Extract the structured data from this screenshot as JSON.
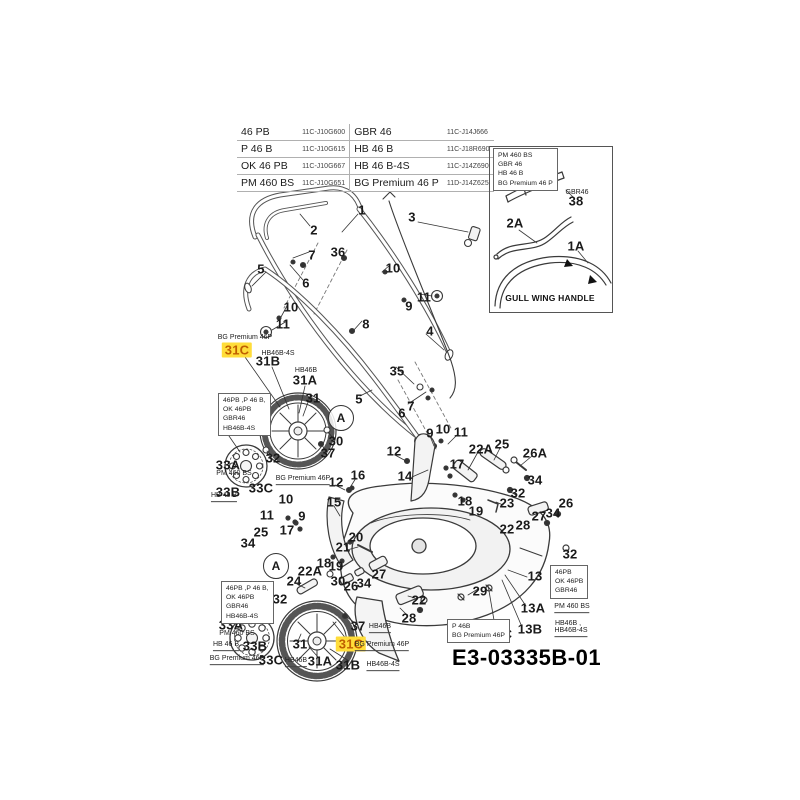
{
  "table": {
    "left": [
      {
        "model": "46 PB",
        "code": "11C-J10G600"
      },
      {
        "model": "P 46 B",
        "code": "11C-J10G615"
      },
      {
        "model": "OK 46 PB",
        "code": "11C-J10G667"
      },
      {
        "model": "PM 460 BS",
        "code": "11C-J10G651"
      }
    ],
    "right": [
      {
        "model": "GBR 46",
        "code": "11C-J14J666"
      },
      {
        "model": "HB 46 B",
        "code": "11C-J18R690"
      },
      {
        "model": "HB 46 B-4S",
        "code": "11C-J14Z690"
      },
      {
        "model": "BG Premium 46 P",
        "code": "11D-J14Z625"
      }
    ]
  },
  "inset": {
    "caption": "GULL WING HANDLE"
  },
  "footer": {
    "code": "E3-03335B-01"
  },
  "colors": {
    "highlight_bg": "#ffdd3a",
    "highlight_text": "#bf5f00",
    "line": "#3a3a3a"
  },
  "callouts": [
    {
      "t": "1",
      "x": 362,
      "y": 210
    },
    {
      "t": "2",
      "x": 314,
      "y": 230
    },
    {
      "t": "3",
      "x": 412,
      "y": 217
    },
    {
      "t": "36",
      "x": 338,
      "y": 252
    },
    {
      "t": "7",
      "x": 312,
      "y": 255
    },
    {
      "t": "5",
      "x": 261,
      "y": 269
    },
    {
      "t": "6",
      "x": 306,
      "y": 283
    },
    {
      "t": "10",
      "x": 393,
      "y": 268
    },
    {
      "t": "11",
      "x": 424,
      "y": 297
    },
    {
      "t": "9",
      "x": 409,
      "y": 306
    },
    {
      "t": "8",
      "x": 366,
      "y": 324
    },
    {
      "t": "10",
      "x": 291,
      "y": 307
    },
    {
      "t": "11",
      "x": 283,
      "y": 324
    },
    {
      "t": "4",
      "x": 430,
      "y": 331
    },
    {
      "t": "35",
      "x": 397,
      "y": 371
    },
    {
      "t": "7",
      "x": 411,
      "y": 406
    },
    {
      "t": "6",
      "x": 402,
      "y": 413
    },
    {
      "t": "5",
      "x": 359,
      "y": 399
    },
    {
      "t": "9",
      "x": 430,
      "y": 433
    },
    {
      "t": "10",
      "x": 443,
      "y": 429
    },
    {
      "t": "11",
      "x": 461,
      "y": 432
    },
    {
      "t": "12",
      "x": 394,
      "y": 451
    },
    {
      "t": "22A",
      "x": 481,
      "y": 449
    },
    {
      "t": "25",
      "x": 502,
      "y": 444
    },
    {
      "t": "26A",
      "x": 535,
      "y": 453
    },
    {
      "t": "17",
      "x": 457,
      "y": 464
    },
    {
      "t": "14",
      "x": 405,
      "y": 476
    },
    {
      "t": "34",
      "x": 535,
      "y": 480
    },
    {
      "t": "32",
      "x": 518,
      "y": 493
    },
    {
      "t": "23",
      "x": 507,
      "y": 503
    },
    {
      "t": "18",
      "x": 465,
      "y": 501
    },
    {
      "t": "19",
      "x": 476,
      "y": 511
    },
    {
      "t": "26",
      "x": 566,
      "y": 503
    },
    {
      "t": "34",
      "x": 553,
      "y": 513
    },
    {
      "t": "27",
      "x": 539,
      "y": 516
    },
    {
      "t": "28",
      "x": 523,
      "y": 525
    },
    {
      "t": "22",
      "x": 507,
      "y": 529
    },
    {
      "t": "32",
      "x": 570,
      "y": 554
    },
    {
      "t": "29",
      "x": 480,
      "y": 591
    },
    {
      "t": "13",
      "x": 535,
      "y": 576
    },
    {
      "t": "13A",
      "x": 533,
      "y": 608
    },
    {
      "t": "13B",
      "x": 530,
      "y": 629
    },
    {
      "t": "13C",
      "x": 500,
      "y": 634
    },
    {
      "t": "31C",
      "x": 237,
      "y": 350,
      "hl": true
    },
    {
      "t": "31B",
      "x": 268,
      "y": 361
    },
    {
      "t": "31A",
      "x": 305,
      "y": 380
    },
    {
      "t": "31",
      "x": 313,
      "y": 398
    },
    {
      "t": "33",
      "x": 225,
      "y": 431
    },
    {
      "t": "A",
      "x": 341,
      "y": 418,
      "circle": true
    },
    {
      "t": "30",
      "x": 336,
      "y": 441
    },
    {
      "t": "37",
      "x": 328,
      "y": 453
    },
    {
      "t": "32",
      "x": 273,
      "y": 458
    },
    {
      "t": "33A",
      "x": 228,
      "y": 465
    },
    {
      "t": "33B",
      "x": 228,
      "y": 492
    },
    {
      "t": "33C",
      "x": 261,
      "y": 488
    },
    {
      "t": "16",
      "x": 358,
      "y": 475
    },
    {
      "t": "12",
      "x": 336,
      "y": 482
    },
    {
      "t": "15",
      "x": 334,
      "y": 502
    },
    {
      "t": "10",
      "x": 286,
      "y": 499
    },
    {
      "t": "11",
      "x": 267,
      "y": 515
    },
    {
      "t": "9",
      "x": 302,
      "y": 516
    },
    {
      "t": "17",
      "x": 287,
      "y": 530
    },
    {
      "t": "25",
      "x": 261,
      "y": 532
    },
    {
      "t": "34",
      "x": 248,
      "y": 543
    },
    {
      "t": "20",
      "x": 356,
      "y": 537
    },
    {
      "t": "21",
      "x": 343,
      "y": 547
    },
    {
      "t": "18",
      "x": 324,
      "y": 563
    },
    {
      "t": "19",
      "x": 336,
      "y": 566
    },
    {
      "t": "22A",
      "x": 310,
      "y": 571
    },
    {
      "t": "A",
      "x": 276,
      "y": 566,
      "circle": true
    },
    {
      "t": "24",
      "x": 294,
      "y": 581
    },
    {
      "t": "30",
      "x": 338,
      "y": 581
    },
    {
      "t": "26",
      "x": 351,
      "y": 586
    },
    {
      "t": "34",
      "x": 364,
      "y": 583
    },
    {
      "t": "27",
      "x": 379,
      "y": 574
    },
    {
      "t": "22",
      "x": 419,
      "y": 600
    },
    {
      "t": "28",
      "x": 409,
      "y": 618
    },
    {
      "t": "32",
      "x": 280,
      "y": 599
    },
    {
      "t": "33",
      "x": 245,
      "y": 611
    },
    {
      "t": "33A",
      "x": 231,
      "y": 625
    },
    {
      "t": "33B",
      "x": 255,
      "y": 646
    },
    {
      "t": "33C",
      "x": 271,
      "y": 660
    },
    {
      "t": "31",
      "x": 300,
      "y": 644
    },
    {
      "t": "31A",
      "x": 320,
      "y": 661
    },
    {
      "t": "31B",
      "x": 348,
      "y": 665
    },
    {
      "t": "31C",
      "x": 351,
      "y": 644,
      "hl": true
    },
    {
      "t": "37",
      "x": 358,
      "y": 626
    },
    {
      "t": "38",
      "x": 576,
      "y": 201
    },
    {
      "t": "2A",
      "x": 515,
      "y": 223
    },
    {
      "t": "1A",
      "x": 576,
      "y": 246
    }
  ],
  "notes": [
    {
      "t": "BG Premium 46P",
      "x": 245,
      "y": 338
    },
    {
      "t": "HB46B-4S",
      "x": 278,
      "y": 354
    },
    {
      "t": "HB46B",
      "x": 306,
      "y": 371
    },
    {
      "t": "PM 460 BS",
      "x": 234,
      "y": 474
    },
    {
      "t": "HB 46 B",
      "x": 224,
      "y": 497,
      "u": true
    },
    {
      "t": "BG Premium 46P",
      "x": 303,
      "y": 480,
      "u": true
    },
    {
      "t": "PM 460 BS",
      "x": 237,
      "y": 634
    },
    {
      "t": "HB 46 B",
      "x": 226,
      "y": 646,
      "u": true
    },
    {
      "t": "BG Premium 46P",
      "x": 237,
      "y": 660,
      "u": true
    },
    {
      "t": "HB46B",
      "x": 296,
      "y": 662,
      "u": true
    },
    {
      "t": "HB46B-4S",
      "x": 383,
      "y": 666,
      "u": true
    },
    {
      "t": "BG Premium 46P",
      "x": 382,
      "y": 646,
      "u": true
    },
    {
      "t": "HB46B",
      "x": 380,
      "y": 628,
      "u": true
    },
    {
      "t": "PM 460 BS",
      "x": 572,
      "y": 608,
      "u": true
    },
    {
      "t": "HB46B ,",
      "x": 568,
      "y": 624
    },
    {
      "t": "HB46B-4S",
      "x": 571,
      "y": 632,
      "u": true
    },
    {
      "t": "GBR46",
      "x": 577,
      "y": 193
    }
  ],
  "boxes": [
    {
      "x": 218,
      "y": 393,
      "lines": [
        "46PB ,P 46 B,",
        "OK 46PB",
        "GBR46",
        "HB46B-4S"
      ]
    },
    {
      "x": 221,
      "y": 581,
      "lines": [
        "46PB ,P 46 B,",
        "OK 46PB",
        "GBR46",
        "HB46B-4S"
      ]
    },
    {
      "x": 550,
      "y": 565,
      "lines": [
        "46PB",
        "OK 46PB",
        "GBR46"
      ]
    },
    {
      "x": 447,
      "y": 619,
      "lines": [
        "P 46B",
        "BG Premium 46P"
      ]
    },
    {
      "x": 493,
      "y": 148,
      "lines": [
        "PM 460 BS",
        "GBR 46",
        "HB 46 B",
        "BG Premium 46 P"
      ]
    }
  ]
}
